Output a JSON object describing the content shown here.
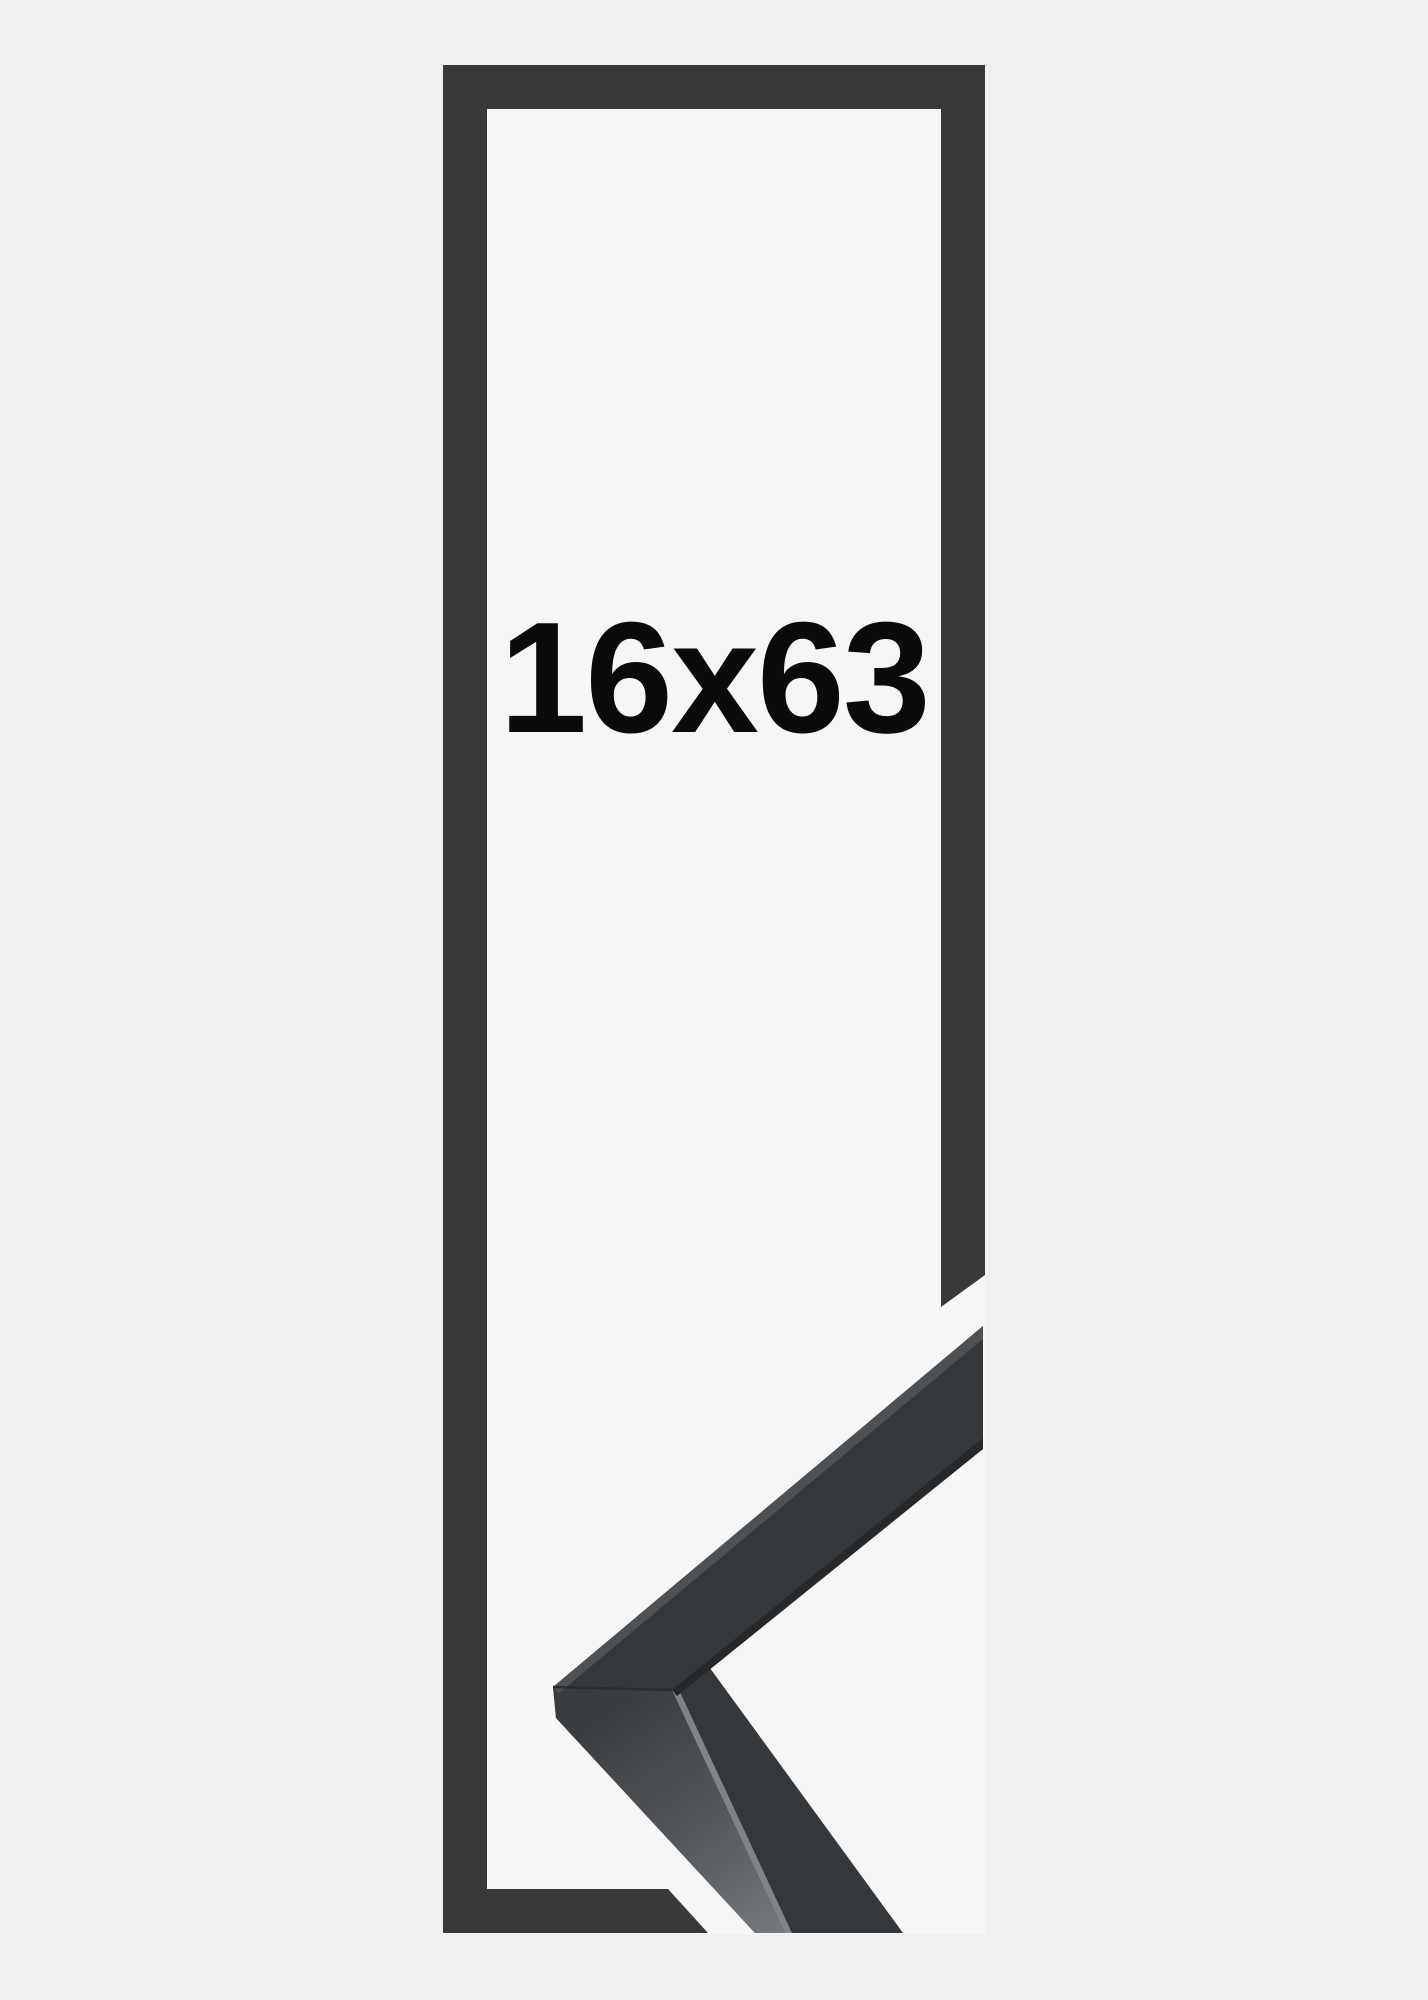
{
  "page": {
    "background": "#f0f0f1"
  },
  "product": {
    "size_label": "16x63",
    "photo_background": "#f6f6f7",
    "frame_outline_color": "#39393b",
    "label_color": "#0a0a0b"
  },
  "corner_sample": {
    "front_face": "#35383a",
    "top_face_dark": "#3a3d3f",
    "top_face_light": "#75787a",
    "edge_highlight": "#818486",
    "upper_top_strip": "#4e5153",
    "upper_bottom_edge": "#26282a",
    "miter_seam": "#2a2c2e"
  }
}
